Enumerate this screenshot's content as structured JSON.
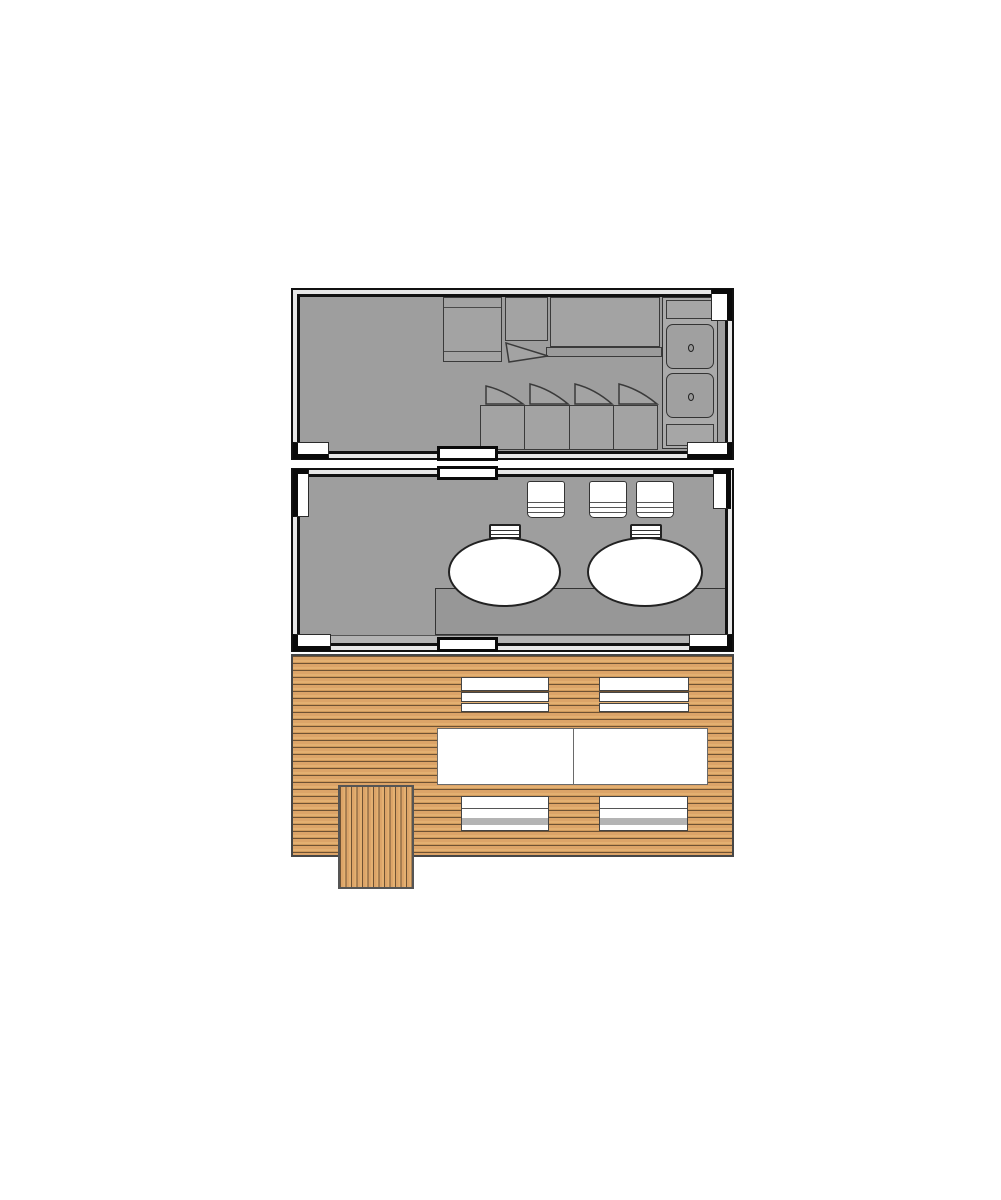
{
  "page": {
    "background": "#ffffff"
  },
  "colors": {
    "page_bg": "#ffffff",
    "frame_line": "#111111",
    "wall_band": "#e7e7e7",
    "room_floor": "#9e9e9e",
    "furniture_fill": "#a3a3a3",
    "furniture_line": "#3a3a3a",
    "counter_fill": "#aaaaaa",
    "platform_fill": "#979797",
    "white_fixture": "#ffffff",
    "deck_wood": "#dca468",
    "deck_groove": "#6f5233",
    "deck_border": "#474747",
    "slat_gray": "#b4b4b4",
    "corner_fitting": "#0a0a0a"
  },
  "plan": {
    "units": [
      {
        "id": "container-top",
        "kind": "container-unit",
        "fixtures": [
          "dresser",
          "wall-cabinet-with-open-door",
          "double-bed",
          "counter-with-two-sinks",
          "four-folding-chairs"
        ],
        "door_openings": 1,
        "corner_fittings": 3
      },
      {
        "id": "container-middle",
        "kind": "container-unit",
        "fixtures": [
          "three-slatted-chairs",
          "two-oval-tubs-with-steps",
          "raised-platform"
        ],
        "door_openings": 2,
        "corner_fittings": 4
      },
      {
        "id": "wooden-deck",
        "kind": "deck",
        "fixtures": [
          "two-upper-slatted-benches",
          "two-white-tables",
          "two-lower-slatted-benches",
          "vertical-plank-step-platform"
        ]
      }
    ]
  }
}
